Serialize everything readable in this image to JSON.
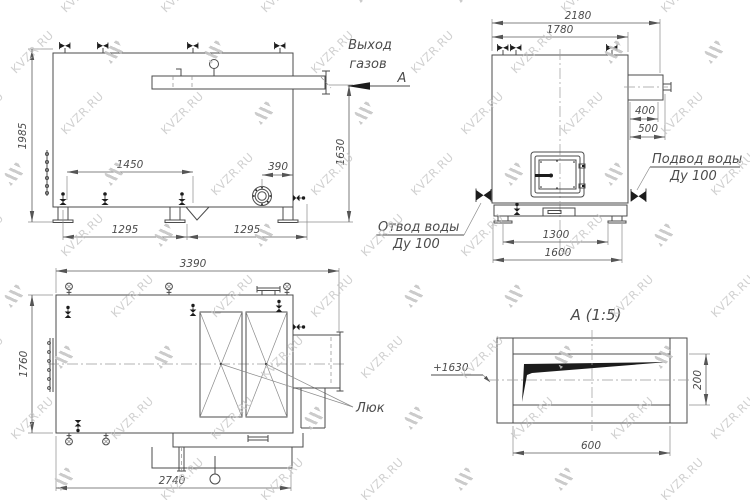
{
  "watermark": {
    "text": "KVZR.RU"
  },
  "side": {
    "gas1": "Выход",
    "gas2": "газов",
    "section_letter": "А",
    "d1985": "1985",
    "d1450": "1450",
    "d390": "390",
    "d1630": "1630",
    "d1295a": "1295",
    "d1295b": "1295"
  },
  "front": {
    "d2180": "2180",
    "d1780": "1780",
    "d400": "400",
    "d500": "500",
    "d1300": "1300",
    "d1600": "1600",
    "inlet1": "Подвод воды",
    "inlet2": "Ду 100",
    "outlet1": "Отвод воды",
    "outlet2": "Ду 100"
  },
  "plan": {
    "d3390": "3390",
    "d1760": "1760",
    "d2740": "2740",
    "hatch": "Люк"
  },
  "detail": {
    "title": "А (1:5)",
    "elevation": "+1630",
    "d600": "600",
    "d200": "200"
  },
  "colors": {
    "background": "#ffffff",
    "main_line": "#4b4b4b",
    "dim_line": "#5a5a5a",
    "black_fill": "#1c1c1c",
    "watermark": "#c4c4c4"
  }
}
